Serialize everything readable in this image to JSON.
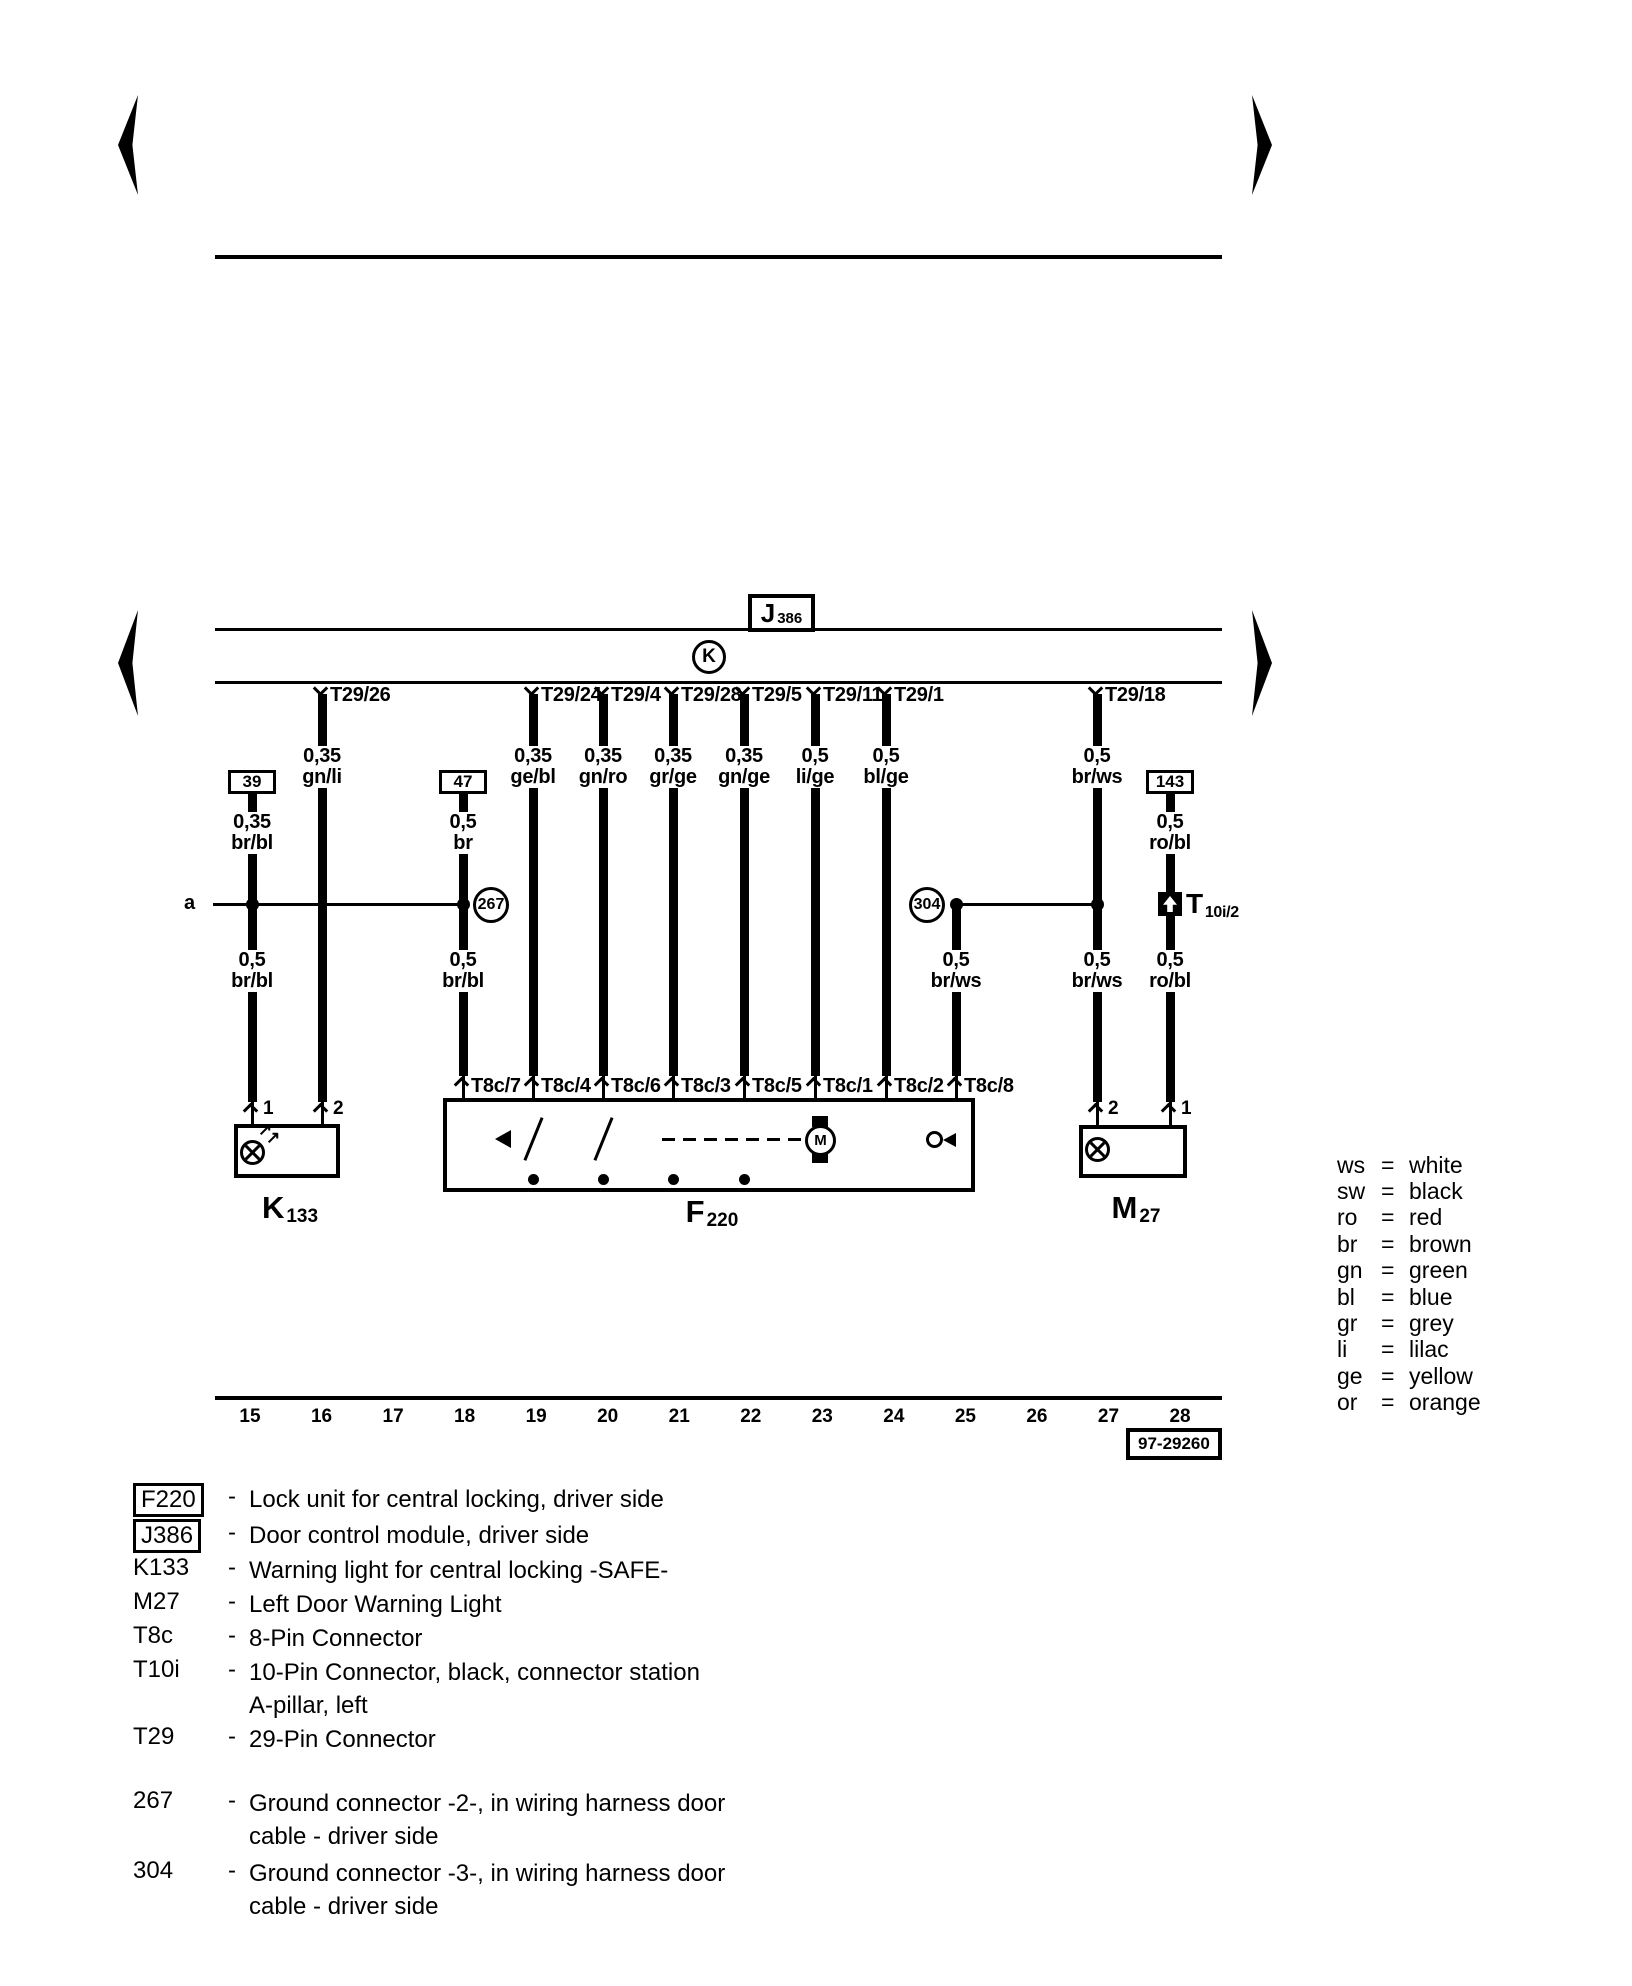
{
  "diagram": {
    "section_label": "a",
    "module": {
      "letter": "J",
      "number": "386"
    },
    "gateway_symbol": "K",
    "t29_pin_labels": [
      "T29/26",
      "T29/24",
      "T29/4",
      "T29/28",
      "T29/5",
      "T29/11",
      "T29/1",
      "T29/18"
    ],
    "t29_wire_specs": [
      {
        "gauge": "0,35",
        "color": "gn/li"
      },
      {
        "gauge": "0,35",
        "color": "ge/bl"
      },
      {
        "gauge": "0,35",
        "color": "gn/ro"
      },
      {
        "gauge": "0,35",
        "color": "gr/ge"
      },
      {
        "gauge": "0,35",
        "color": "gn/ge"
      },
      {
        "gauge": "0,5",
        "color": "li/ge"
      },
      {
        "gauge": "0,5",
        "color": "bl/ge"
      },
      {
        "gauge": "0,5",
        "color": "br/ws"
      }
    ],
    "terminal_labels": [
      "39",
      "47",
      "143"
    ],
    "terminal_wire_specs": [
      {
        "gauge": "0,35",
        "color": "br/bl"
      },
      {
        "gauge": "0,5",
        "color": "br"
      },
      {
        "gauge": "0,5",
        "color": "ro/bl"
      }
    ],
    "lower_wire_specs": [
      {
        "gauge": "0,5",
        "color": "br/bl"
      },
      {
        "gauge": "0,5",
        "color": "br/bl"
      },
      {
        "gauge": "0,5",
        "color": "br/ws"
      },
      {
        "gauge": "0,5",
        "color": "br/ws"
      },
      {
        "gauge": "0,5",
        "color": "ro/bl"
      }
    ],
    "t8c_pin_labels": [
      "T8c/7",
      "T8c/4",
      "T8c/6",
      "T8c/3",
      "T8c/5",
      "T8c/1",
      "T8c/2",
      "T8c/8"
    ],
    "ground_connectors": [
      "267",
      "304"
    ],
    "components": {
      "k133": {
        "letter": "K",
        "number": "133",
        "pins": [
          "1",
          "2"
        ]
      },
      "f220": {
        "letter": "F",
        "number": "220",
        "motor_label": "M"
      },
      "m27": {
        "letter": "M",
        "number": "27",
        "pins": [
          "2",
          "1"
        ]
      },
      "t10i": {
        "letter": "T",
        "number": "10i/2"
      }
    },
    "tracks": [
      "15",
      "16",
      "17",
      "18",
      "19",
      "20",
      "21",
      "22",
      "23",
      "24",
      "25",
      "26",
      "27",
      "28"
    ],
    "drawing_number": "97-29260"
  },
  "color_legend": [
    {
      "code": "ws",
      "name": "white"
    },
    {
      "code": "sw",
      "name": "black"
    },
    {
      "code": "ro",
      "name": "red"
    },
    {
      "code": "br",
      "name": "brown"
    },
    {
      "code": "gn",
      "name": "green"
    },
    {
      "code": "bl",
      "name": "blue"
    },
    {
      "code": "gr",
      "name": "grey"
    },
    {
      "code": "li",
      "name": "lilac"
    },
    {
      "code": "ge",
      "name": "yellow"
    },
    {
      "code": "or",
      "name": "orange"
    }
  ],
  "component_list": [
    {
      "code": "F220",
      "boxed": true,
      "desc": [
        "Lock unit for central locking, driver side"
      ]
    },
    {
      "code": "J386",
      "boxed": true,
      "desc": [
        "Door control module, driver side"
      ]
    },
    {
      "code": "K133",
      "boxed": false,
      "desc": [
        "Warning light for central locking -SAFE-"
      ]
    },
    {
      "code": "M27",
      "boxed": false,
      "desc": [
        "Left Door Warning Light"
      ]
    },
    {
      "code": "T8c",
      "boxed": false,
      "desc": [
        "8-Pin Connector"
      ]
    },
    {
      "code": "T10i",
      "boxed": false,
      "desc": [
        "10-Pin Connector, black, connector station",
        "A-pillar, left"
      ]
    },
    {
      "code": "T29",
      "boxed": false,
      "desc": [
        "29-Pin Connector"
      ]
    },
    {
      "code": "267",
      "boxed": false,
      "desc": [
        "Ground connector -2-, in wiring harness door",
        "cable - driver side"
      ]
    },
    {
      "code": "304",
      "boxed": false,
      "desc": [
        "Ground connector -3-, in wiring harness door",
        "cable - driver side"
      ]
    }
  ]
}
